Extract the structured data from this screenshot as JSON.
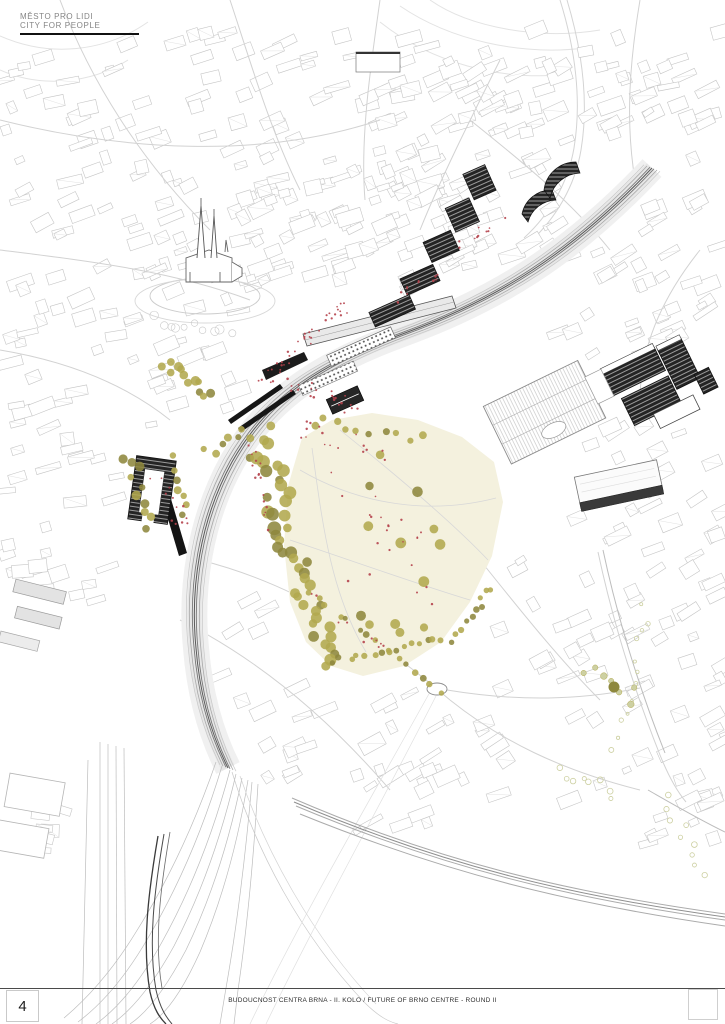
{
  "header": {
    "title_line1": "MĚSTO PRO LIDI",
    "title_line2": "CITY FOR PEOPLE"
  },
  "footer": {
    "page_number": "4",
    "caption": "BUDOUCNOST CENTRA BRNA - II. KOLO / FUTURE OF BRNO CENTRE - ROUND II"
  },
  "colors": {
    "line": "#c6c6c6",
    "line_dark": "#8f8f8f",
    "ink": "#1d1d1d",
    "park": "#f4f1de",
    "tree": "#b2a94f",
    "tree_dark": "#8e883d",
    "tree_light": "#cdd0a2",
    "accent_red": "#b5434c",
    "facade_dark": "#242424"
  }
}
